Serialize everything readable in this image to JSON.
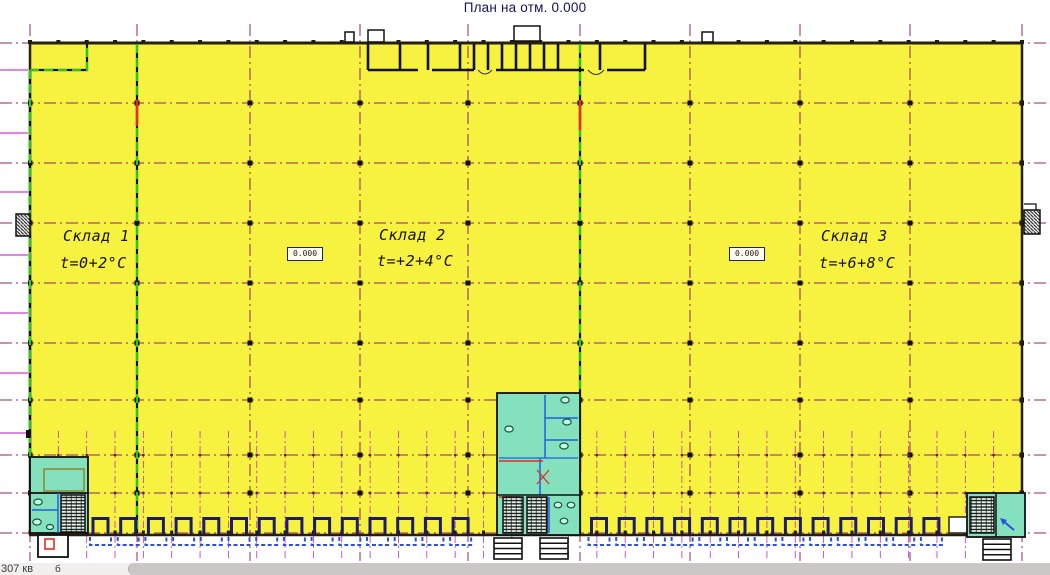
{
  "title": "План на отм. 0.000",
  "warehouses": [
    {
      "name": "Склад 1",
      "temp": "t=0+2°C"
    },
    {
      "name": "Склад 2",
      "temp": "t=+2+4°C"
    },
    {
      "name": "Склад 3",
      "temp": "t=+6+8°C"
    }
  ],
  "elevation_marks": [
    {
      "value": "0.000"
    },
    {
      "value": "0.000"
    }
  ],
  "status_bar": {
    "text": "307 кв",
    "suffix": "б"
  },
  "colors": {
    "hall_fill": "#F7F23F",
    "room_fill": "#85E0BE",
    "fixture_fill": "#CFF3E2",
    "axis_dark": "#8F2468",
    "margin_magenta": "#D23AD2",
    "bay_magenta": "#C72EC7",
    "firewall_green": "#1FCC1F",
    "door_navy": "#1B1B70",
    "leveler_blue": "#2A50E0",
    "partition_blue": "#1E5FE0",
    "alarm_red": "#E03020",
    "wall_dark": "#26200A",
    "inner_step_olive": "#8A8420"
  }
}
